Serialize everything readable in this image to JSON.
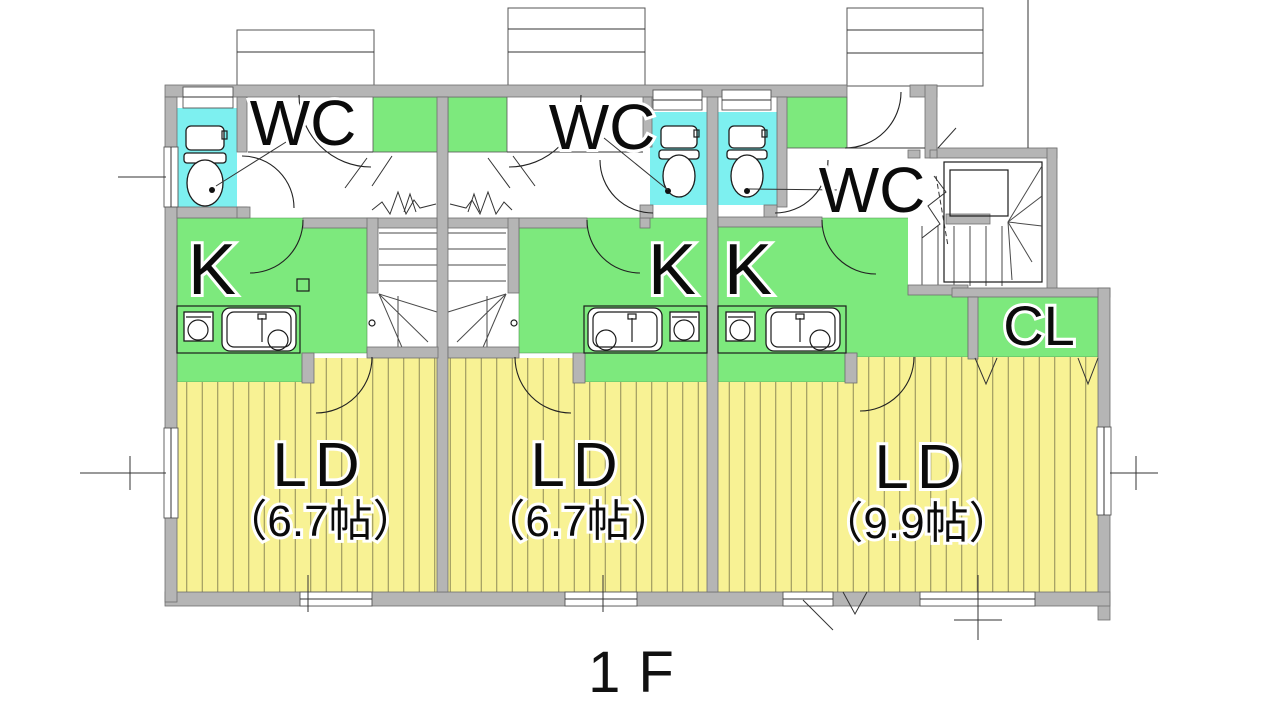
{
  "floor_label": "1F",
  "units": [
    {
      "name": "unit-1",
      "wc_label": "WC",
      "kitchen_label": "K",
      "living_label": "LD",
      "living_size": "（6.7帖）"
    },
    {
      "name": "unit-2",
      "wc_label": "WC",
      "kitchen_label": "K",
      "living_label": "LD",
      "living_size": "（6.7帖）"
    },
    {
      "name": "unit-3",
      "wc_label": "WC",
      "kitchen_label": "K",
      "living_label": "LD",
      "living_size": "（9.9帖）",
      "closet_label": "CL"
    }
  ],
  "colors": {
    "wall": "#b5b5b5",
    "wc_floor": "#7df0f0",
    "kitchen_floor": "#7de97d",
    "living_floor": "#f8f294",
    "line": "#222222"
  }
}
